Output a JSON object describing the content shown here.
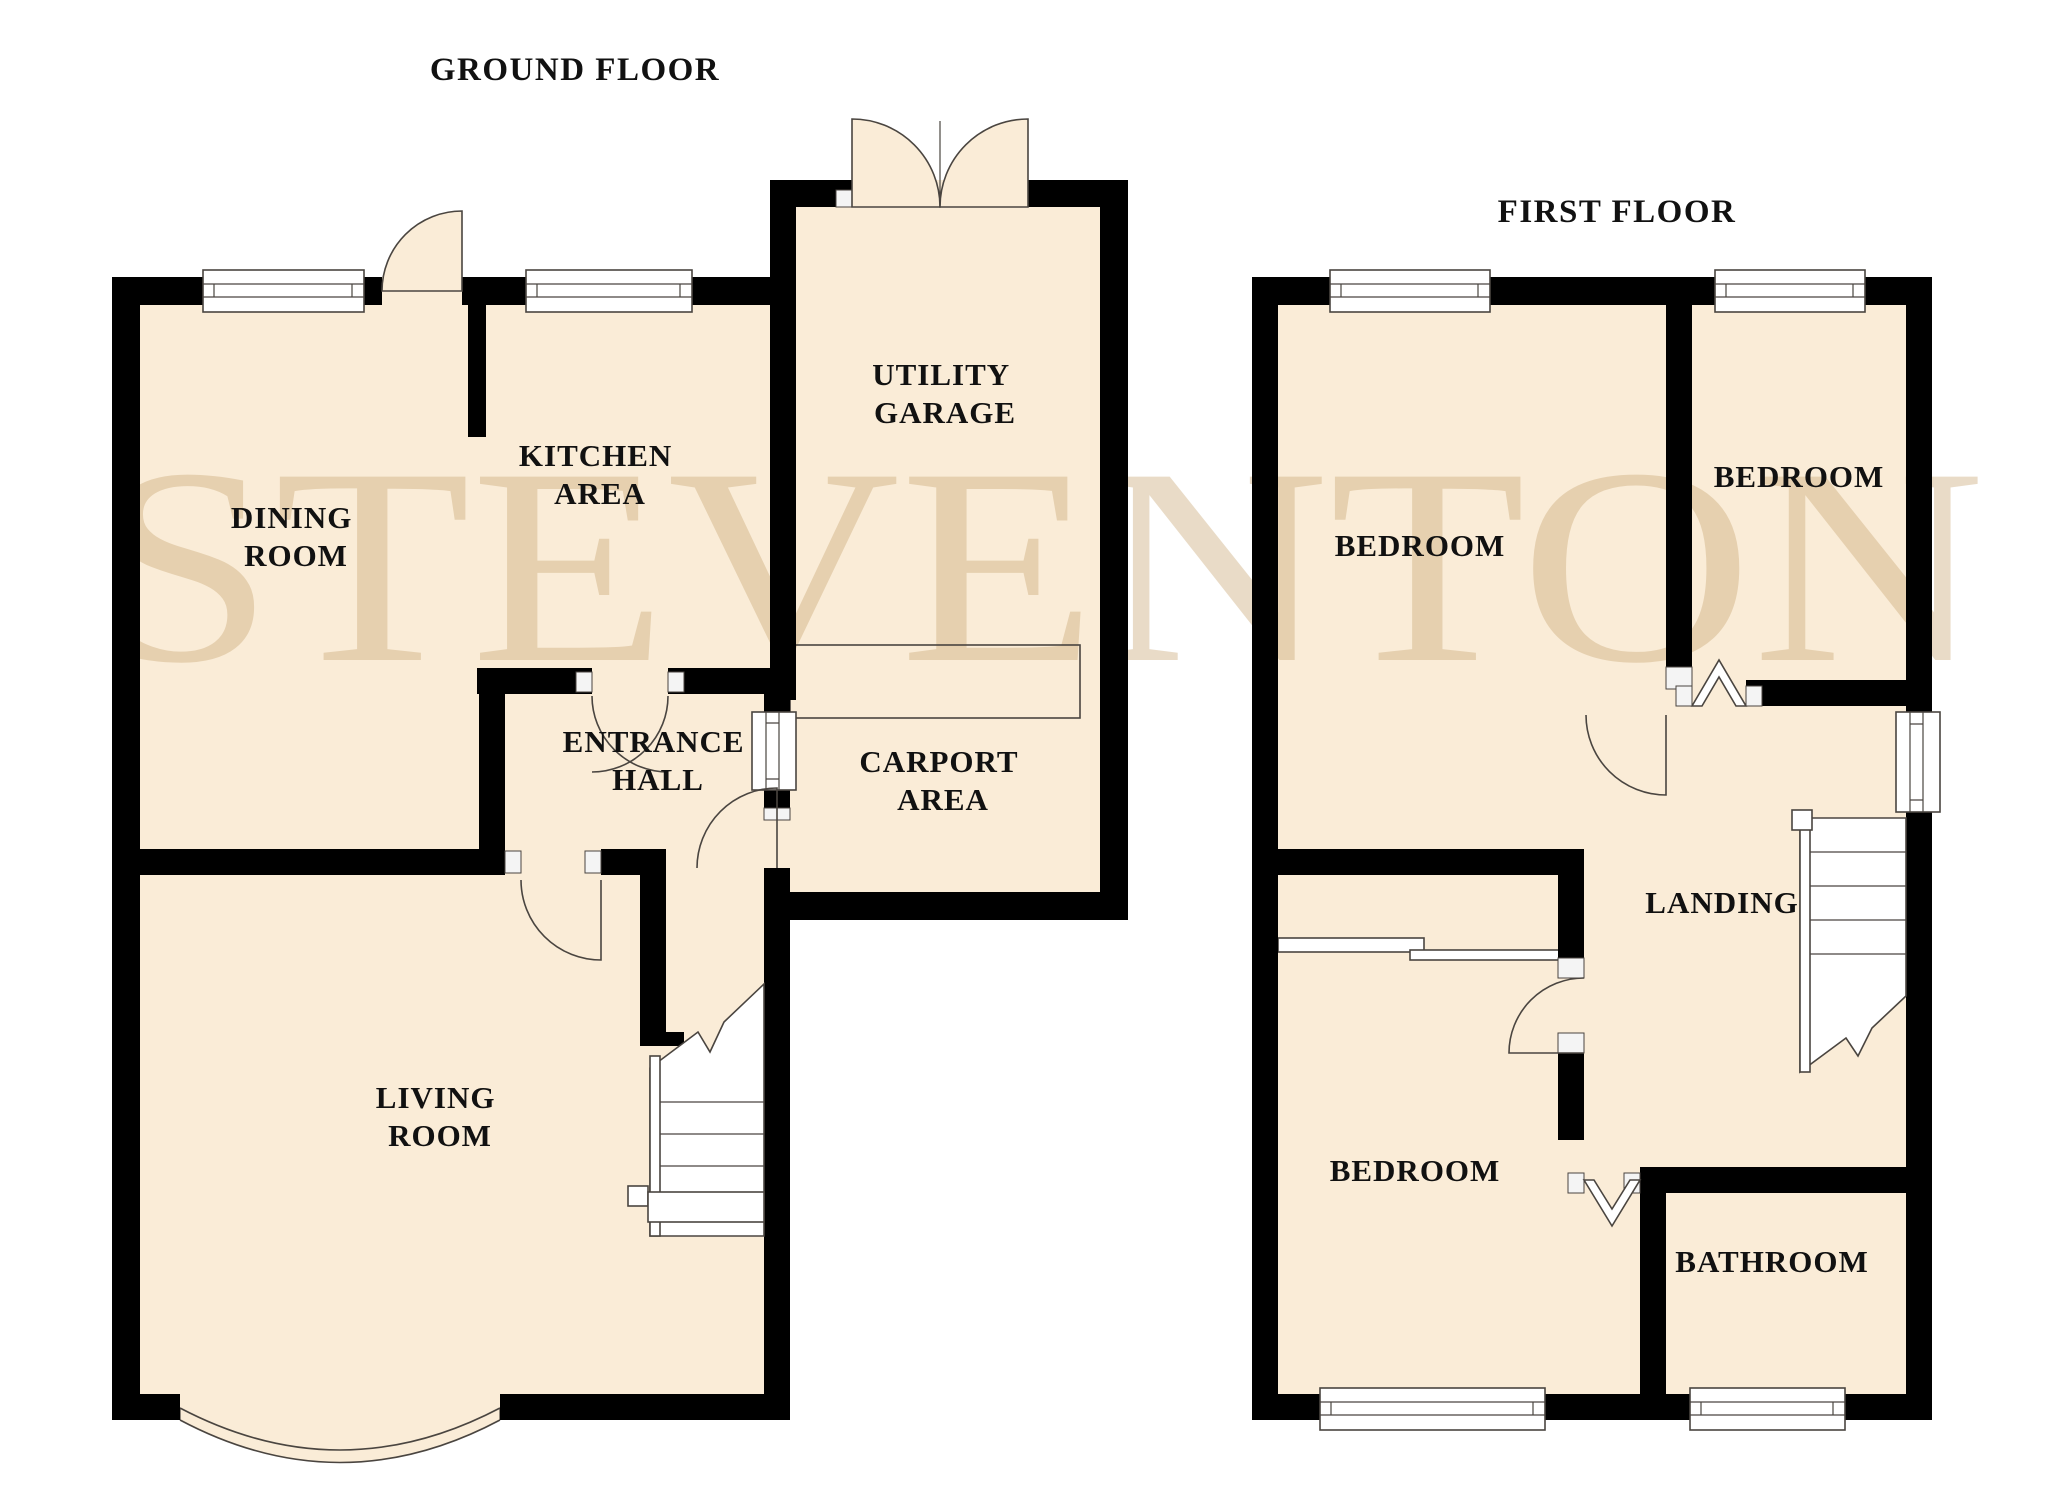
{
  "watermark_text": "STEVENTON",
  "colors": {
    "background": "#ffffff",
    "room_fill": "#faecd7",
    "wall": "#000000",
    "detail_line": "#4a4540",
    "watermark": "#c9a876",
    "label_text": "#111111"
  },
  "ground_floor": {
    "title": "GROUND FLOOR",
    "labels": {
      "dining": [
        "DINING",
        "ROOM"
      ],
      "kitchen": [
        "KITCHEN",
        "AREA"
      ],
      "garage": [
        "UTILITY",
        "GARAGE"
      ],
      "hall": [
        "ENTRANCE",
        "HALL"
      ],
      "carport": [
        "CARPORT",
        "AREA"
      ],
      "living": [
        "LIVING",
        "ROOM"
      ]
    }
  },
  "first_floor": {
    "title": "FIRST FLOOR",
    "labels": {
      "bedroom_top_left": "BEDROOM",
      "bedroom_top_right": "BEDROOM",
      "landing": "LANDING",
      "bedroom_bottom": "BEDROOM",
      "bathroom": "BATHROOM"
    }
  }
}
